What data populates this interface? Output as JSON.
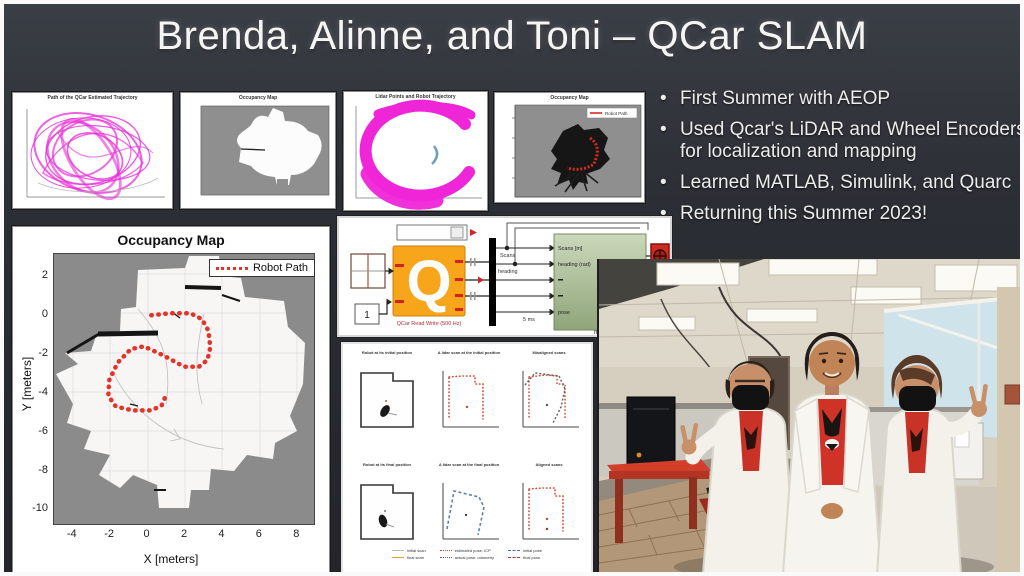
{
  "slide": {
    "title": "Brenda, Alinne, and Toni – QCar SLAM"
  },
  "bullets": [
    "First Summer with AEOP",
    "Used Qcar's LiDAR and Wheel Encoders for localization and mapping",
    "Learned MATLAB, Simulink, and Quarc",
    "Returning this Summer 2023!"
  ],
  "thumbnails": [
    {
      "title": "Path of the QCar Estimated Trajectory"
    },
    {
      "title": "Occupancy Map"
    },
    {
      "title": "Lidar Points and Robot Trajectory"
    },
    {
      "title": "Occupancy Map",
      "legend_label": "Robot Path"
    }
  ],
  "chart_data": {
    "type": "line",
    "title": "Occupancy Map",
    "xlabel": "X [meters]",
    "ylabel": "Y [meters]",
    "xlim": [
      -5,
      9
    ],
    "ylim": [
      -10.8,
      3.2
    ],
    "x_ticks": [
      -4,
      -2,
      0,
      2,
      4,
      6,
      8
    ],
    "y_ticks": [
      2,
      0,
      -2,
      -4,
      -6,
      -8,
      -10
    ],
    "grid": true,
    "legend_position": "top-right",
    "legend_label": "Robot Path",
    "series": [
      {
        "name": "Robot Path",
        "color": "#e63327",
        "style": "dotted",
        "points": [
          [
            0.2,
            0.05
          ],
          [
            1.2,
            0.15
          ],
          [
            2.3,
            0.15
          ],
          [
            2.9,
            -0.15
          ],
          [
            3.25,
            -0.75
          ],
          [
            3.35,
            -1.6
          ],
          [
            3.2,
            -2.25
          ],
          [
            2.75,
            -2.6
          ],
          [
            1.95,
            -2.6
          ],
          [
            0.8,
            -2.0
          ],
          [
            -0.2,
            -1.55
          ],
          [
            -0.9,
            -1.7
          ],
          [
            -1.6,
            -2.4
          ],
          [
            -2.05,
            -3.3
          ],
          [
            -2.1,
            -4.1
          ],
          [
            -1.7,
            -4.65
          ],
          [
            -0.8,
            -4.85
          ],
          [
            0.2,
            -4.85
          ],
          [
            0.75,
            -4.6
          ],
          [
            0.95,
            -4.15
          ]
        ]
      }
    ]
  },
  "simulink": {
    "qcar_logo": "Q",
    "qcar_caption": "QCar Read Write (500 Hz)",
    "constant_value": "1",
    "wire_label_scans": "Scans",
    "wire_label_heading": "heading",
    "wire_label_rate": "5 ms",
    "green_ports": [
      "Scans [m]",
      "heading (rad)",
      "pose"
    ],
    "green_caption": "map"
  },
  "subplots": {
    "titles": [
      "Robot at its initial position",
      "A lidar scan at the initial position",
      "Misaligned scans",
      "Robot at its final position",
      "A lidar scan at the final position",
      "Aligned scans"
    ],
    "legend": [
      "initial scan",
      "final scan",
      "estimated pose: ICP",
      "actual pose: odometry",
      "initial pose",
      "final pose"
    ]
  },
  "photo": {
    "description": "Three students in white lab coats and red shirts, two wearing black face masks, posing with peace signs in an office lab"
  },
  "colors": {
    "slide_bg": "#2b2e34",
    "magenta": "#ee22d2",
    "path_red": "#e63327",
    "map_unknown_gray": "#8b8b8b",
    "qcar_orange": "#f7a61b",
    "green_block": "#aec39a",
    "scope_red": "#cf2b20"
  }
}
